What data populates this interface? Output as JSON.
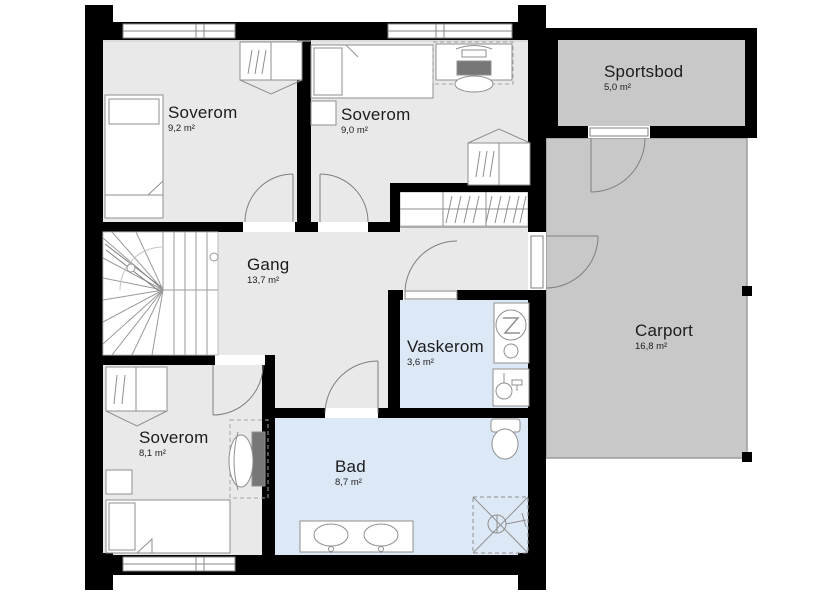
{
  "floorplan": {
    "rooms": [
      {
        "id": "soverom-1",
        "name": "Soverom",
        "area": "9,2 m²"
      },
      {
        "id": "soverom-2",
        "name": "Soverom",
        "area": "9,0 m²"
      },
      {
        "id": "sportsbod",
        "name": "Sportsbod",
        "area": "5,0 m²"
      },
      {
        "id": "gang",
        "name": "Gang",
        "area": "13,7 m²"
      },
      {
        "id": "vaskerom",
        "name": "Vaskerom",
        "area": "3,6 m²"
      },
      {
        "id": "carport",
        "name": "Carport",
        "area": "16,8 m²"
      },
      {
        "id": "soverom-3",
        "name": "Soverom",
        "area": "8,1 m²"
      },
      {
        "id": "bad",
        "name": "Bad",
        "area": "8,7 m²"
      }
    ],
    "colors": {
      "wall": "#000000",
      "room_floor": "#e9e9e9",
      "wet_room_floor": "#dce8f6",
      "outdoor_floor": "#c8c8c8",
      "stair_floor": "#ffffff",
      "background": "#ffffff"
    }
  }
}
